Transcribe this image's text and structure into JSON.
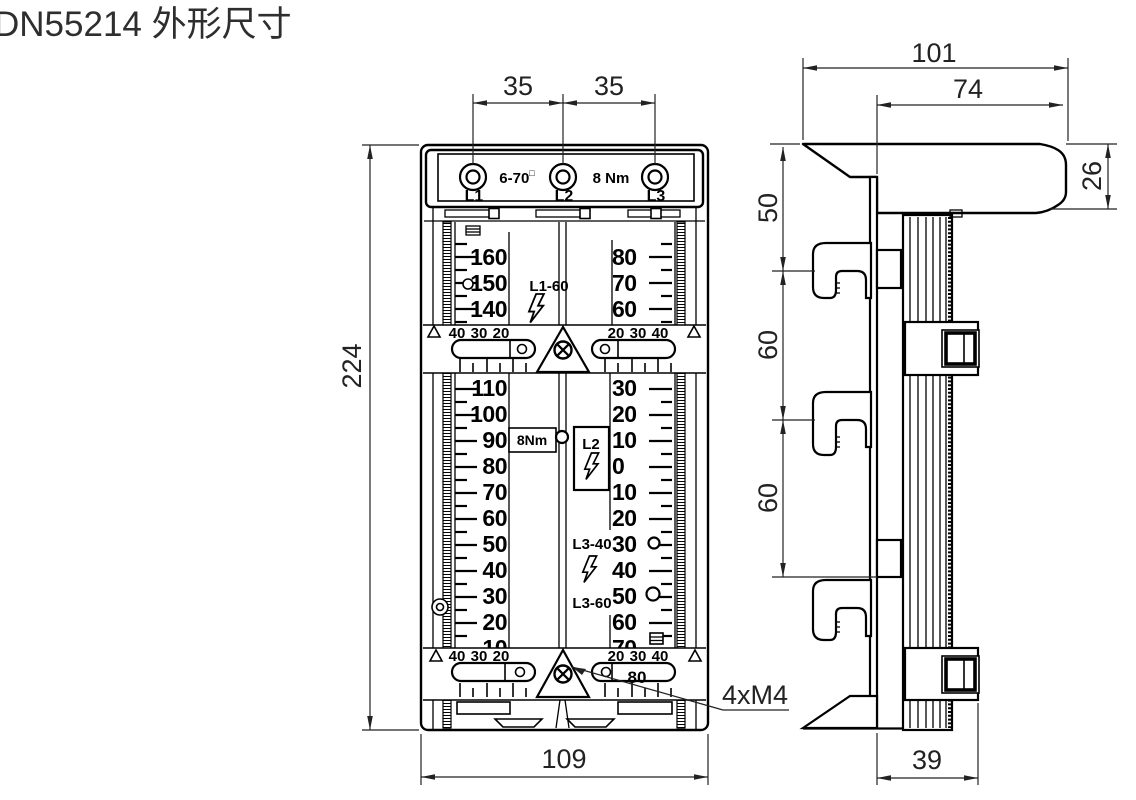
{
  "title": "DN55214 外形尺寸",
  "colors": {
    "line": "#000000",
    "dim_text": "#222222",
    "title_text": "#2e2e2e",
    "background": "#ffffff"
  },
  "front": {
    "terminal_labels": [
      "L1",
      "L2",
      "L3"
    ],
    "wire_range": "6-70",
    "wire_range_unit": "□",
    "torque": "8 Nm",
    "upper_left_scale": [
      "160",
      "150",
      "140"
    ],
    "upper_right_scale": [
      "80",
      "70",
      "60"
    ],
    "fuse_label_top": "L1-60",
    "band_left": [
      "40",
      "30",
      "20"
    ],
    "band_right": [
      "20",
      "30",
      "40"
    ],
    "left_scale": [
      "110",
      "100",
      "90",
      "80",
      "70",
      "60",
      "50",
      "40",
      "30",
      "20",
      "10"
    ],
    "right_scale": [
      "30",
      "20",
      "10",
      "0",
      "10",
      "20",
      "30",
      "40",
      "50",
      "60",
      "70"
    ],
    "torque_small": "8Nm",
    "l2_label": "L2",
    "l3_40": "L3-40",
    "l3_60": "L3-60",
    "slot_value": "80"
  },
  "dims": {
    "pitch_l": "35",
    "pitch_r": "35",
    "height": "224",
    "width": "109",
    "screws": "4xM4",
    "depth": "101",
    "depth_inner": "74",
    "cap": "26",
    "seg_top": "50",
    "seg_mid": "60",
    "seg_bot": "60",
    "foot": "39"
  }
}
